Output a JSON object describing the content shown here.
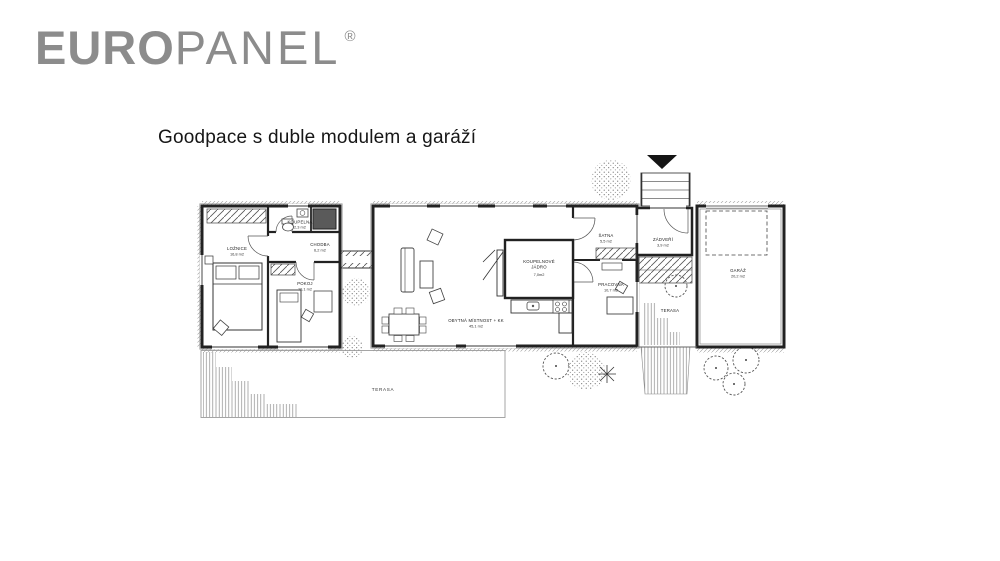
{
  "brand": {
    "logo_bold": "EURO",
    "logo_light": "PANEL",
    "registered_mark": "®",
    "logo_color": "#8c8c8c"
  },
  "page": {
    "title": "Goodpace s duble modulem a garáží"
  },
  "plan": {
    "line_color": "#1f1f1f",
    "rooms": {
      "loznice": {
        "name": "LOŽNICE",
        "area": "16,8 m2"
      },
      "koupelna": {
        "name": "KOUPELNA",
        "area": "2,3 m2"
      },
      "chodba": {
        "name": "CHODBA",
        "area": "6,2 m2"
      },
      "pokoj": {
        "name": "POKOJ",
        "area": "10,1 m2"
      },
      "obytna": {
        "name": "OBYTNÁ MÍSTNOST + KK",
        "area": "45,1 m2"
      },
      "jadro": {
        "name_line1": "KOUPELNOVÉ",
        "name_line2": "JÁDRO",
        "area": "7,0m2"
      },
      "satna": {
        "name": "ŠATNA",
        "area": "5,5 m2"
      },
      "pracovna": {
        "name": "PRACOVNA",
        "area": "10,7 m2"
      },
      "zadveri": {
        "name": "ZÁDVEŘÍ",
        "area": "3,9 m2"
      },
      "terasa_vychod": {
        "name": "TERASA"
      },
      "garaz": {
        "name": "GARÁŽ",
        "area": "20,2 m2"
      },
      "terasa_jih": {
        "name": "TERASA"
      }
    }
  }
}
